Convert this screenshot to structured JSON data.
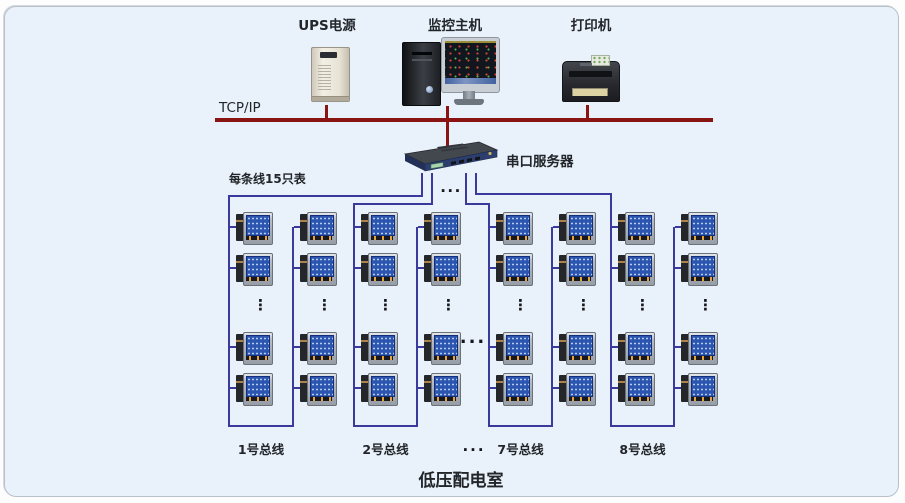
{
  "header": {
    "ups_label": "UPS电源",
    "host_label": "监控主机",
    "printer_label": "打印机",
    "tcpip_label": "TCP/IP"
  },
  "server": {
    "label": "串口服务器",
    "outputs_ellipsis": "..."
  },
  "note_label": "每条线15只表",
  "mid_buses_ellipsis": "...",
  "bus_labels_ellipsis": "...",
  "column_ellipsis": "⋮",
  "buses": [
    {
      "label": "1号总线",
      "meters_visible": 8
    },
    {
      "label": "2号总线",
      "meters_visible": 8
    },
    {
      "label": "7号总线",
      "meters_visible": 8
    },
    {
      "label": "8号总线",
      "meters_visible": 8
    }
  ],
  "room_label": "低压配电室",
  "colors": {
    "panel_bg": "#e9f1fa",
    "tcpip_line": "#8a1412",
    "bus_line": "#3a3a9c"
  }
}
